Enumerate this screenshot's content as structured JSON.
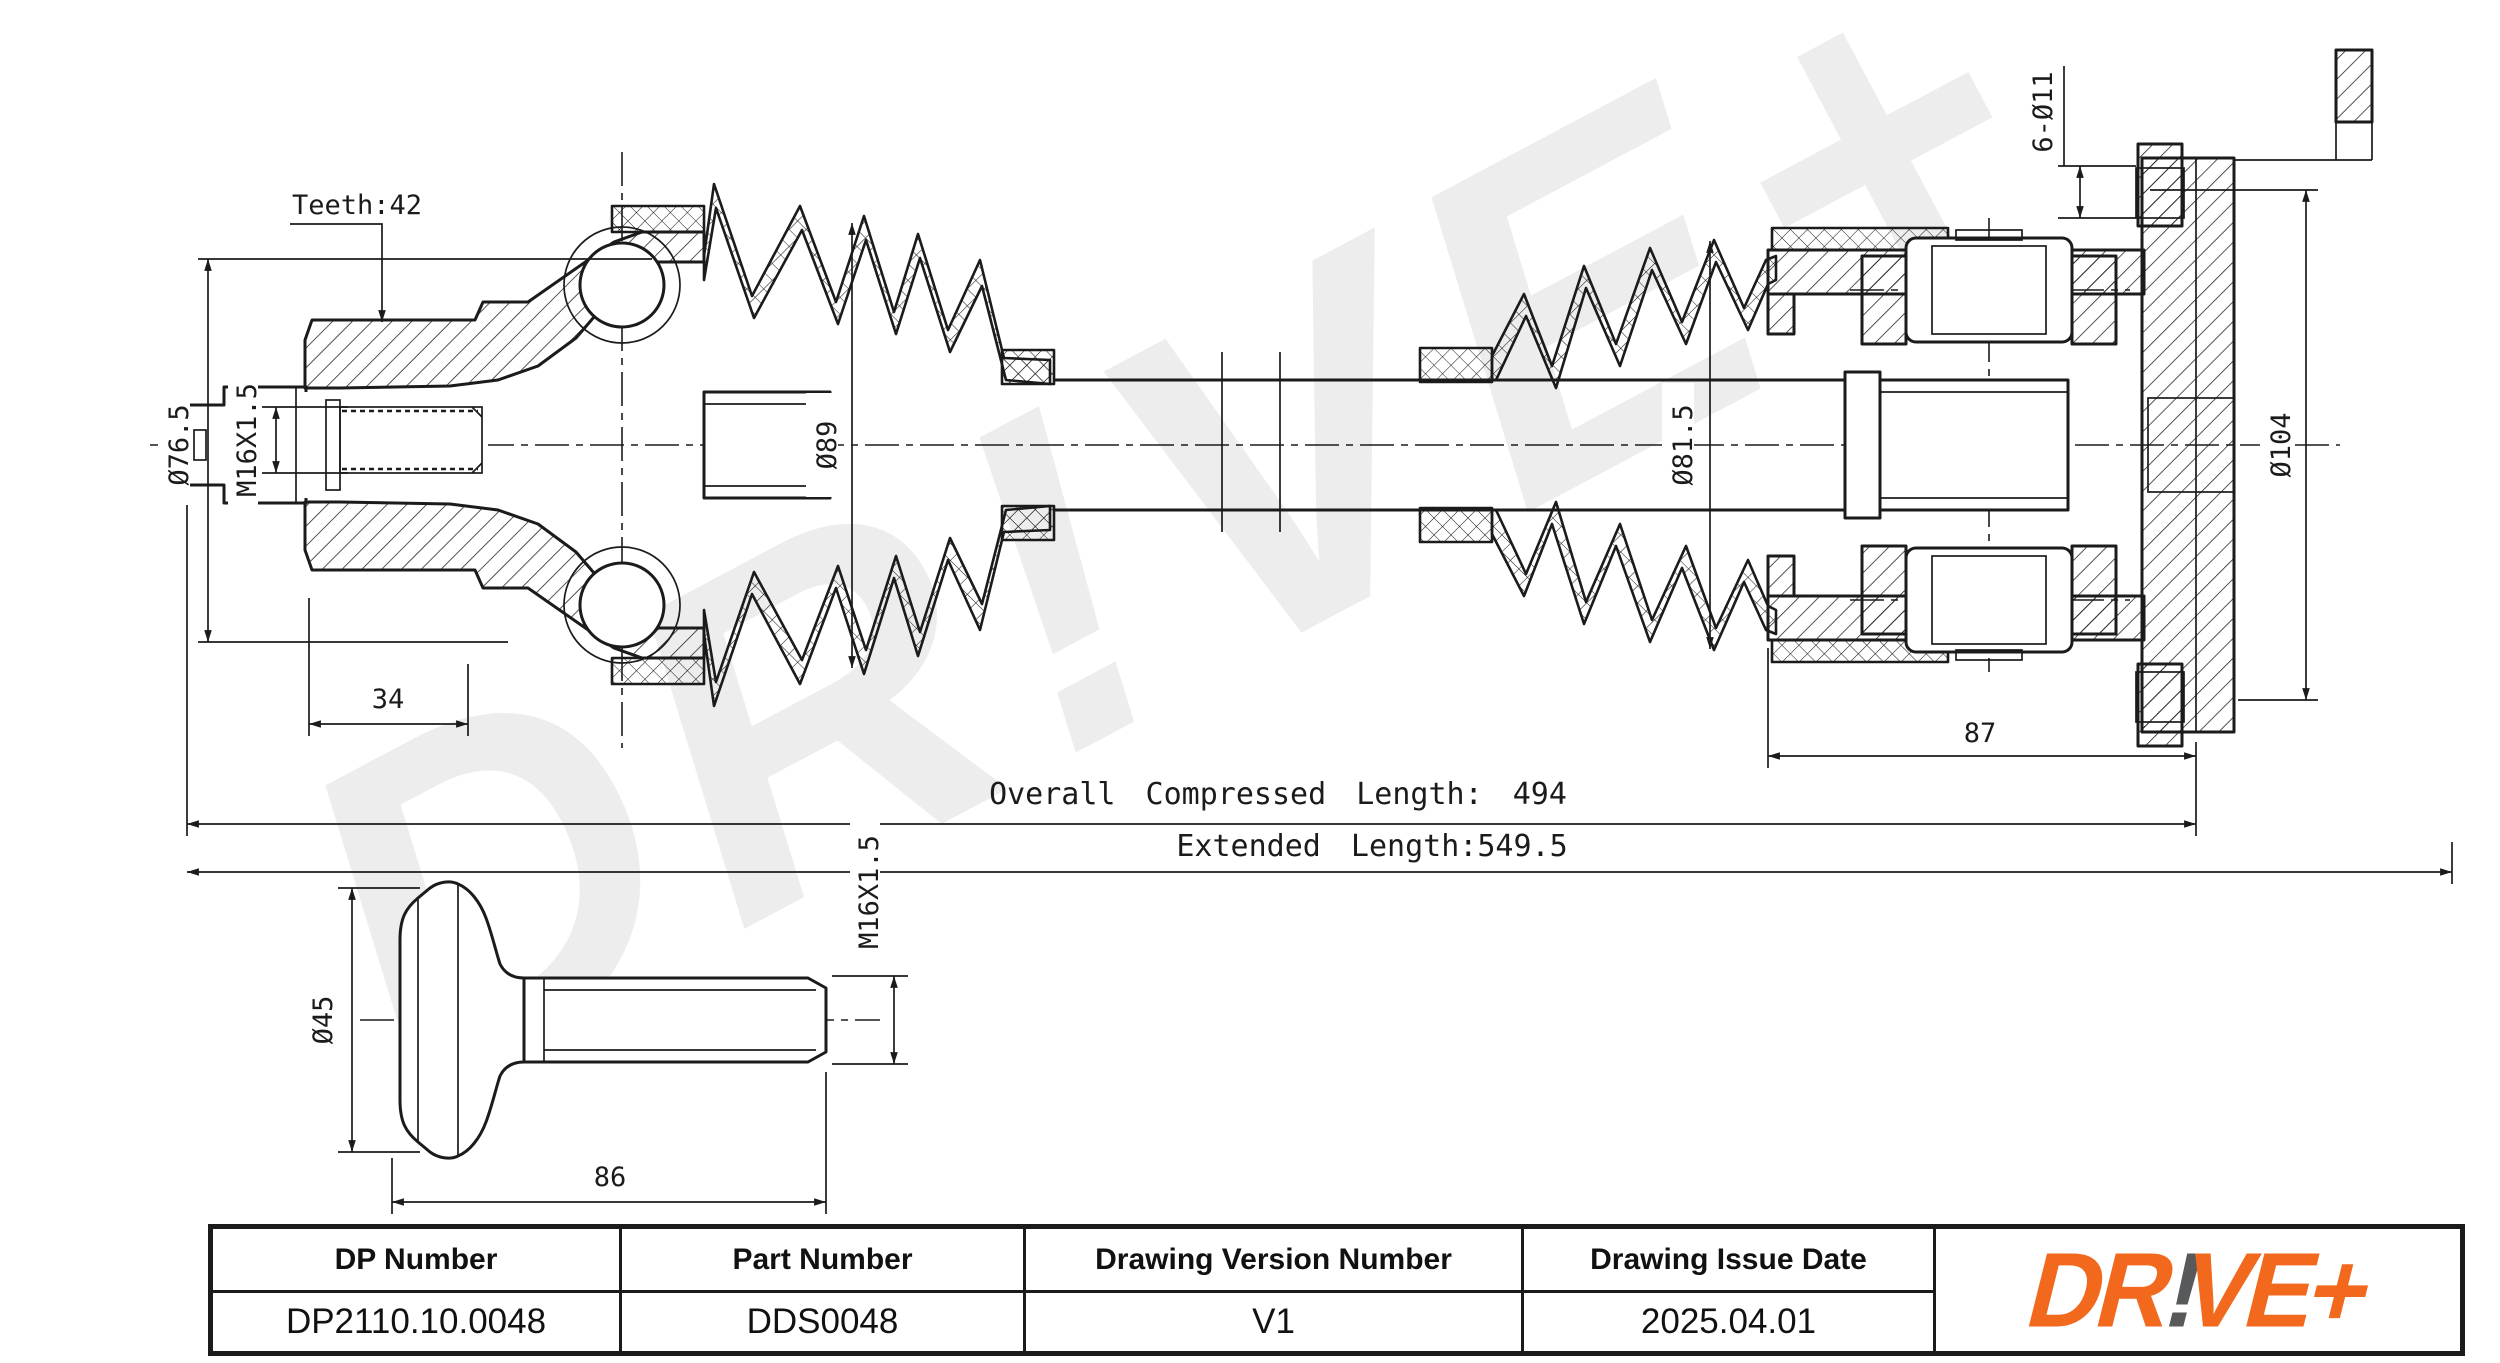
{
  "watermark": "DR!VE+",
  "annotations": {
    "teeth": "Teeth:42",
    "dia_outer_joint": "Ø76.5",
    "thread_left": "M16X1.5",
    "dim_34": "34",
    "dia_boot_left": "Ø89",
    "dia_boot_right": "Ø81.5",
    "dia_flange": "Ø104",
    "bolt_holes": "6-Ø11",
    "dim_87": "87",
    "overall_length": "Overall Compressed Length: 494",
    "extended_length": "Extended Length:549.5",
    "bolt_dia": "Ø45",
    "bolt_length": "86",
    "bolt_thread": "M16X1.5"
  },
  "title_block": {
    "headers": [
      "DP Number",
      "Part Number",
      "Drawing Version Number",
      "Drawing Issue Date"
    ],
    "values": [
      "DP2110.10.0048",
      "DDS0048",
      "V1",
      "2025.04.01"
    ]
  },
  "logo": {
    "dr": "DR",
    "bang": "!",
    "ve": "VE+"
  },
  "colors": {
    "logo_orange": "#F2691E",
    "logo_gray": "#58595B",
    "line": "#1B1B1B",
    "watermark": "#EDEDED"
  }
}
